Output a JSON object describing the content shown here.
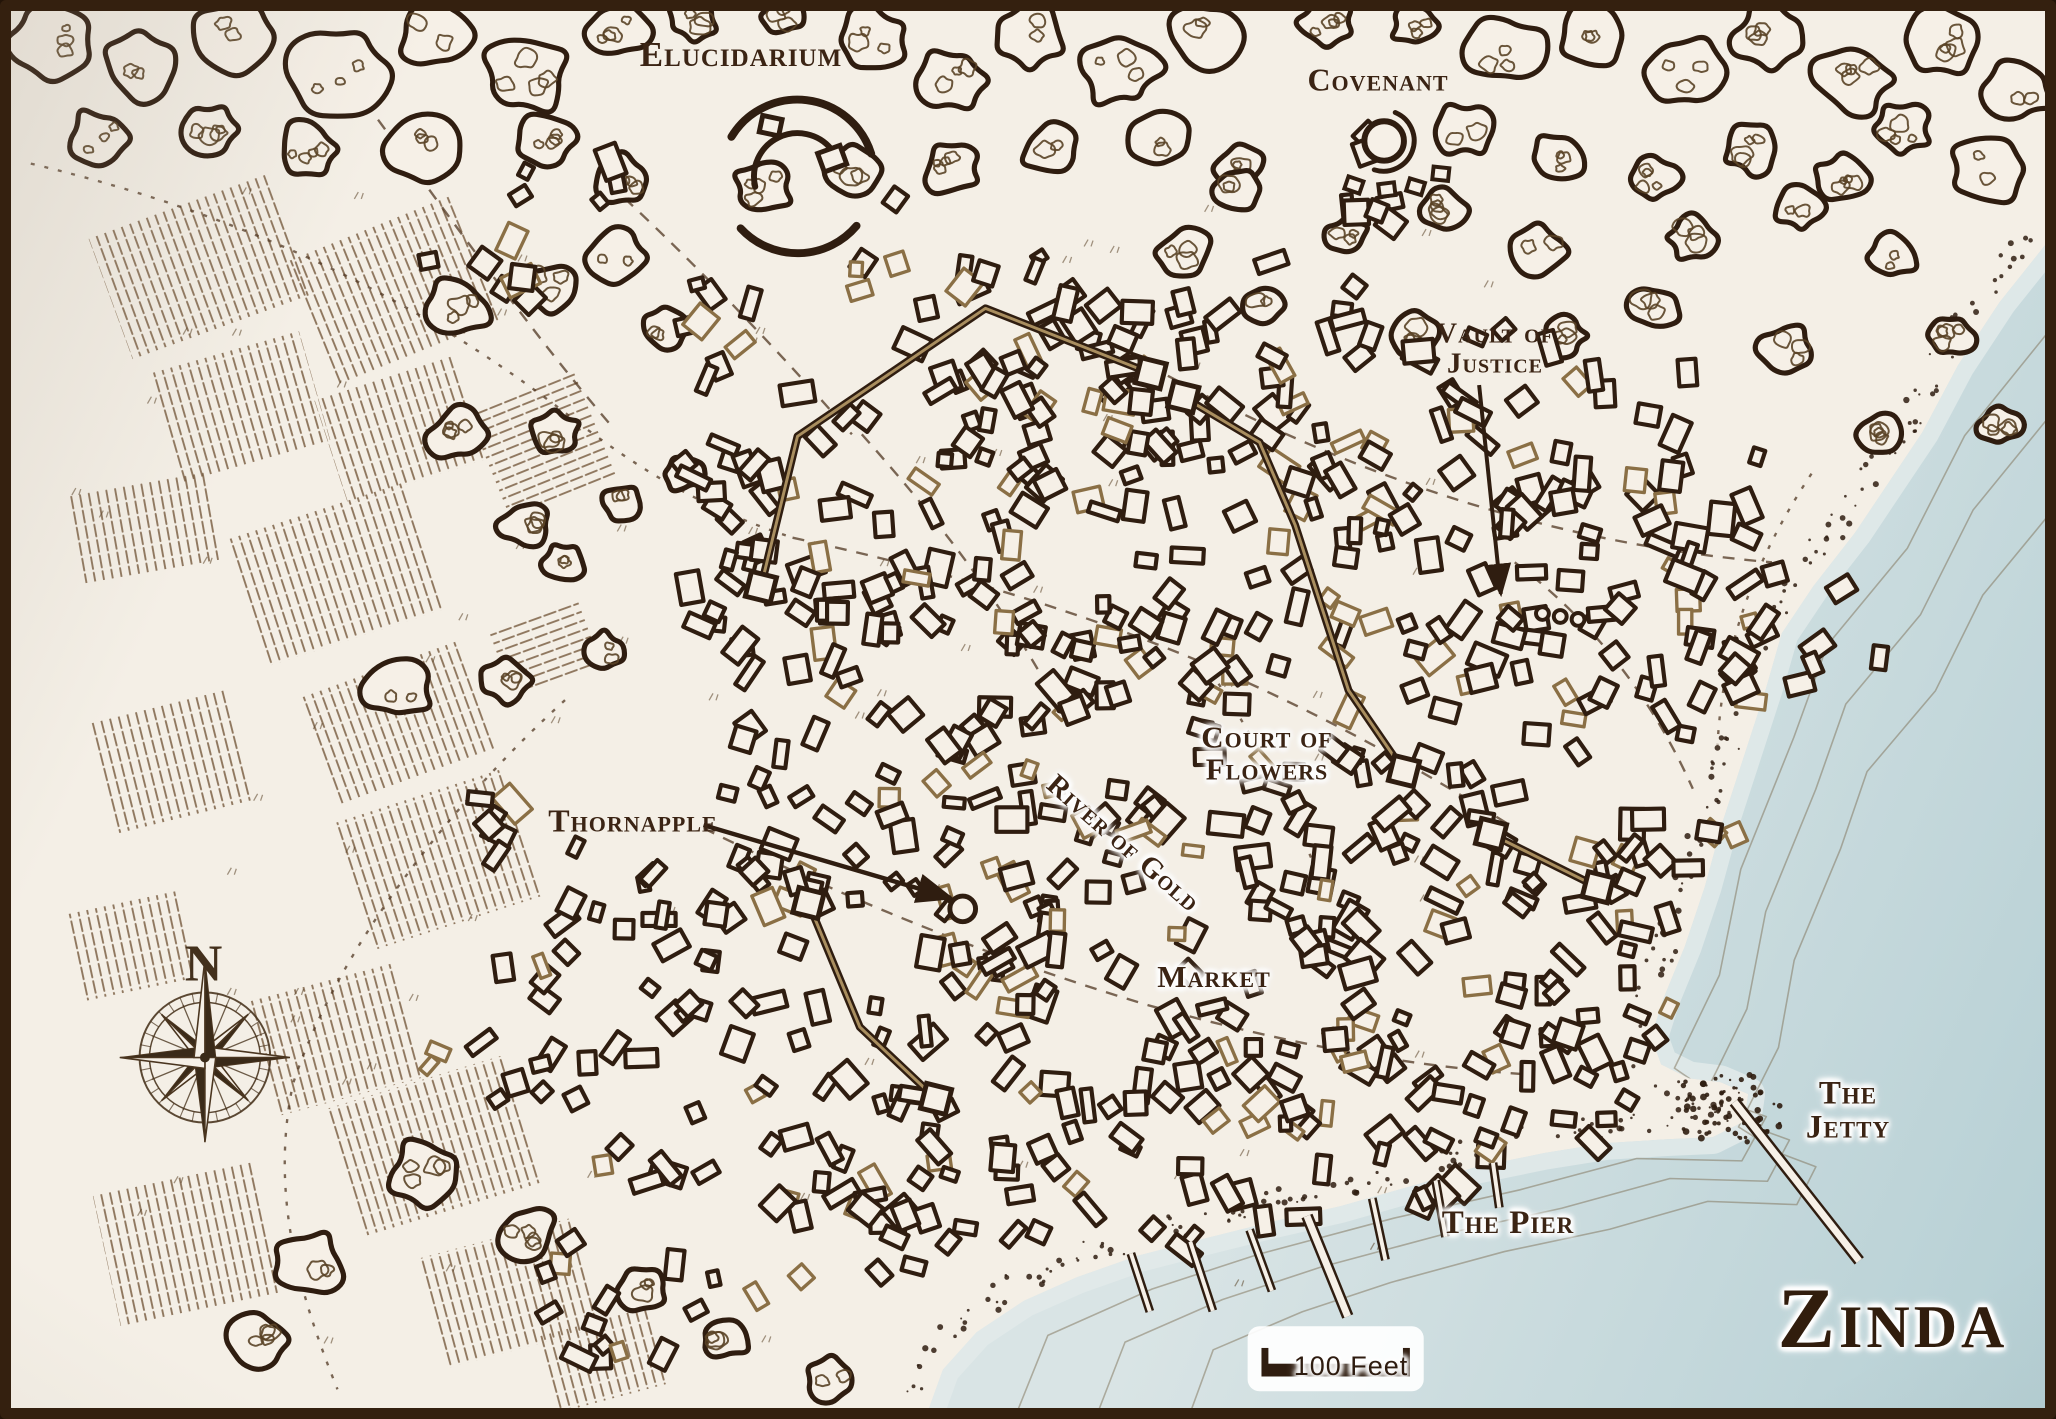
{
  "map": {
    "title": "Zinda",
    "scale_label": "100 Feet",
    "compass": {
      "north_label": "N"
    },
    "labels": {
      "elucidarium": {
        "text": "Elucidarium"
      },
      "covenant": {
        "text": "Covenant"
      },
      "vault_of_justice": {
        "line1": "Vault of",
        "line2": "Justice"
      },
      "court_of_flowers": {
        "line1": "Court of",
        "line2": "Flowers"
      },
      "river_of_gold": {
        "text": "River of Gold"
      },
      "thornapple": {
        "text": "Thornapple"
      },
      "market": {
        "text": "Market"
      },
      "the_pier": {
        "text": "The Pier"
      },
      "the_jetty": {
        "line1": "The",
        "line2": "Jetty"
      }
    },
    "colors": {
      "ink": "#2f1d10",
      "paper": "#f6f0e7",
      "water_near": "#d9e4e5",
      "water_far": "#b5cfd4",
      "accent_tan": "#8a7352",
      "label": "#3b2414",
      "frame": "#34200f"
    }
  }
}
